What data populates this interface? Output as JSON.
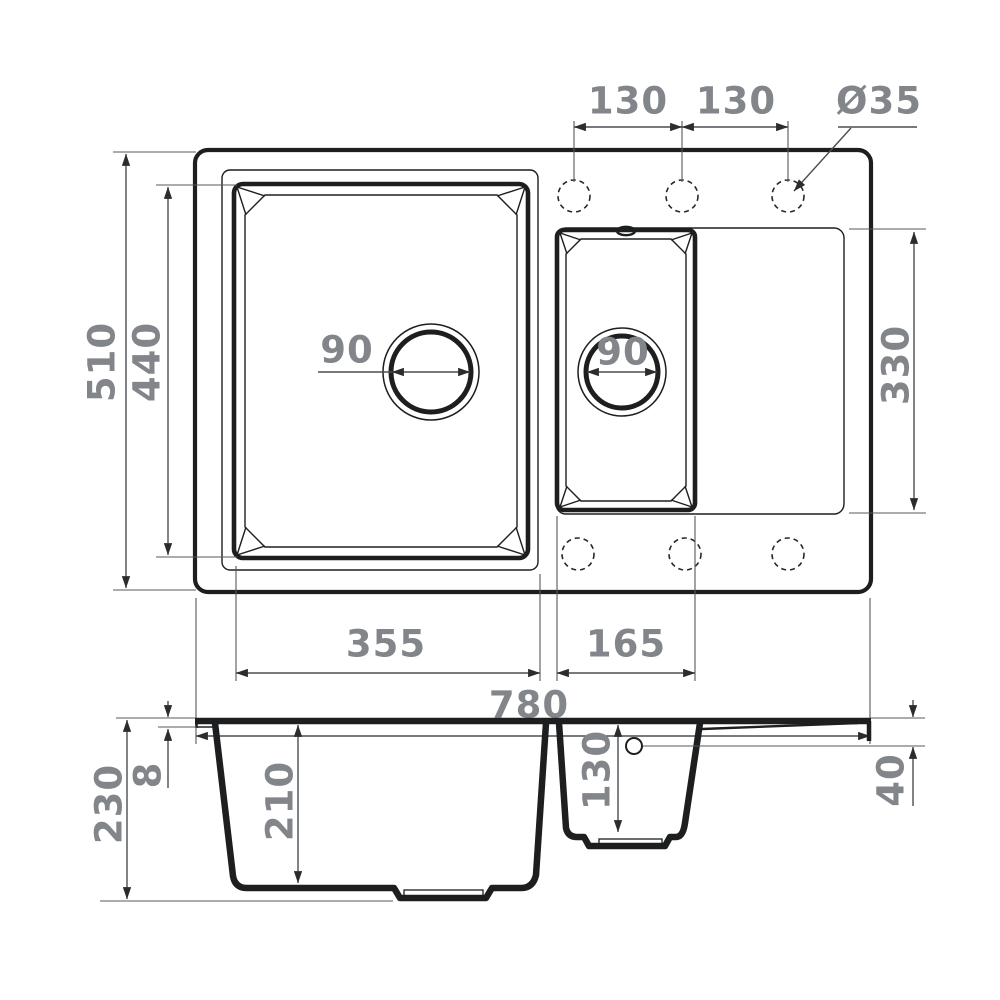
{
  "drawing": {
    "title_semantic": "kitchen-sink-technical-drawing",
    "top_view": {
      "overall_width": "780",
      "overall_depth": "510",
      "main_bowl_length": "440",
      "main_bowl_width": "355",
      "small_bowl_width": "165",
      "drainboard_depth": "330",
      "tap_hole_spacing_left": "130",
      "tap_hole_spacing_right": "130",
      "tap_hole_diameter": "Ø35",
      "main_drain_diameter": "90",
      "small_drain_diameter": "90"
    },
    "section_view": {
      "overall_height": "230",
      "rim_thickness": "8",
      "main_bowl_depth": "210",
      "small_bowl_depth": "130",
      "drainboard_drop": "40"
    },
    "colors": {
      "line": "#1c1e20",
      "dimension_line": "#4b4f52",
      "label_text": "#82868a",
      "background": "#ffffff"
    }
  }
}
